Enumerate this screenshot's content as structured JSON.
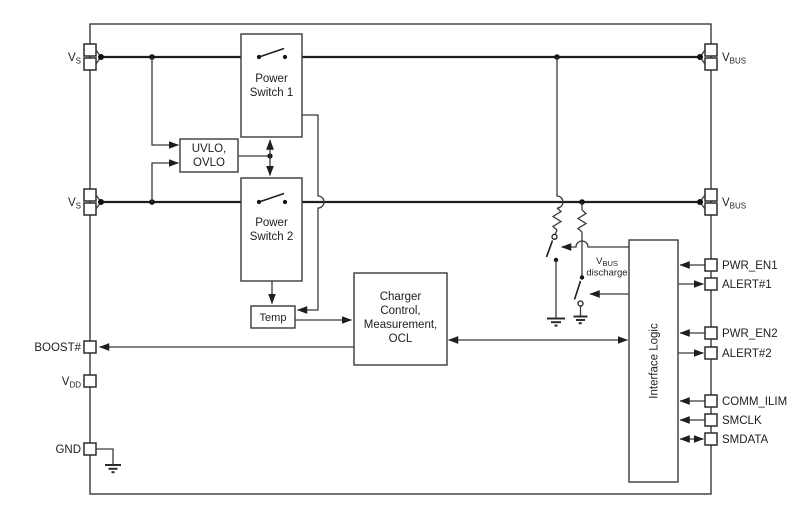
{
  "blocks": {
    "power_switch_1": {
      "line1": "Power",
      "line2": "Switch 1"
    },
    "power_switch_2": {
      "line1": "Power",
      "line2": "Switch 2"
    },
    "uvlo_ovlo": {
      "line1": "UVLO,",
      "line2": "OVLO"
    },
    "temp": {
      "label": "Temp"
    },
    "charger": {
      "line1": "Charger",
      "line2": "Control,",
      "line3": "Measurement,",
      "line4": "OCL"
    },
    "interface_logic": {
      "label": "Interface Logic"
    }
  },
  "pins": {
    "vs1": {
      "main": "V",
      "sub": "S"
    },
    "vs2": {
      "main": "V",
      "sub": "S"
    },
    "boost": {
      "label": "BOOST#"
    },
    "vdd": {
      "main": "V",
      "sub": "DD"
    },
    "gnd": {
      "label": "GND"
    },
    "vbus1": {
      "main": "V",
      "sub": "BUS"
    },
    "vbus2": {
      "main": "V",
      "sub": "BUS"
    },
    "pwr_en1": {
      "label": "PWR_EN1"
    },
    "alert1": {
      "label": "ALERT#1"
    },
    "pwr_en2": {
      "label": "PWR_EN2"
    },
    "alert2": {
      "label": "ALERT#2"
    },
    "comm_ilim": {
      "label": "COMM_ILIM"
    },
    "smclk": {
      "label": "SMCLK"
    },
    "smdata": {
      "label": "SMDATA"
    }
  },
  "annotations": {
    "vbus_discharge": {
      "main": "V",
      "sub": "BUS",
      "line2": "discharge"
    }
  },
  "colors": {
    "background": "#ffffff",
    "wire": "#3a3a3a",
    "power_wire": "#1e1e1e",
    "text": "#1e1e1e"
  }
}
